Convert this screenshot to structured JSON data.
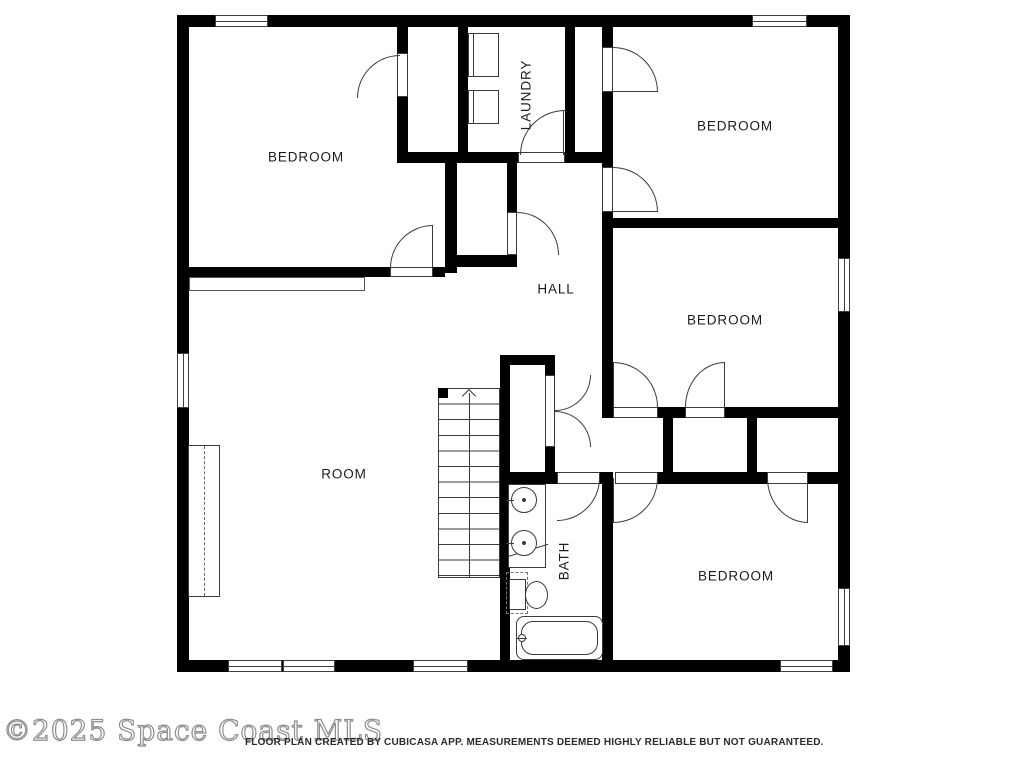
{
  "rooms": [
    {
      "name": "bedroom-top-left",
      "label": "BEDROOM"
    },
    {
      "name": "laundry",
      "label": "LAUNDRY"
    },
    {
      "name": "bedroom-top-right",
      "label": "BEDROOM"
    },
    {
      "name": "hall",
      "label": "HALL"
    },
    {
      "name": "bedroom-middle-right",
      "label": "BEDROOM"
    },
    {
      "name": "room",
      "label": "ROOM"
    },
    {
      "name": "bath",
      "label": "BATH"
    },
    {
      "name": "bedroom-bottom-right",
      "label": "BEDROOM"
    }
  ],
  "fixtures": {
    "staircase": "stairs with up arrow",
    "washer": "square appliance",
    "dryer": "square appliance",
    "vanity-sinks": "counter with two round basins",
    "toilet": "tank and bowl",
    "bathtub": "rounded tub with faucet",
    "wardrobe": "dashed cabinet"
  },
  "footer": {
    "watermark": "©2025 Space Coast MLS",
    "disclaimer": "FLOOR PLAN CREATED BY CUBICASA APP. MEASUREMENTS DEEMED HIGHLY RELIABLE BUT NOT GUARANTEED."
  },
  "colors": {
    "wall": "#000000",
    "line": "#3a3a3a",
    "background": "#ffffff",
    "watermark": "#8e8e8e",
    "disclaimer": "#2b2b2b"
  }
}
